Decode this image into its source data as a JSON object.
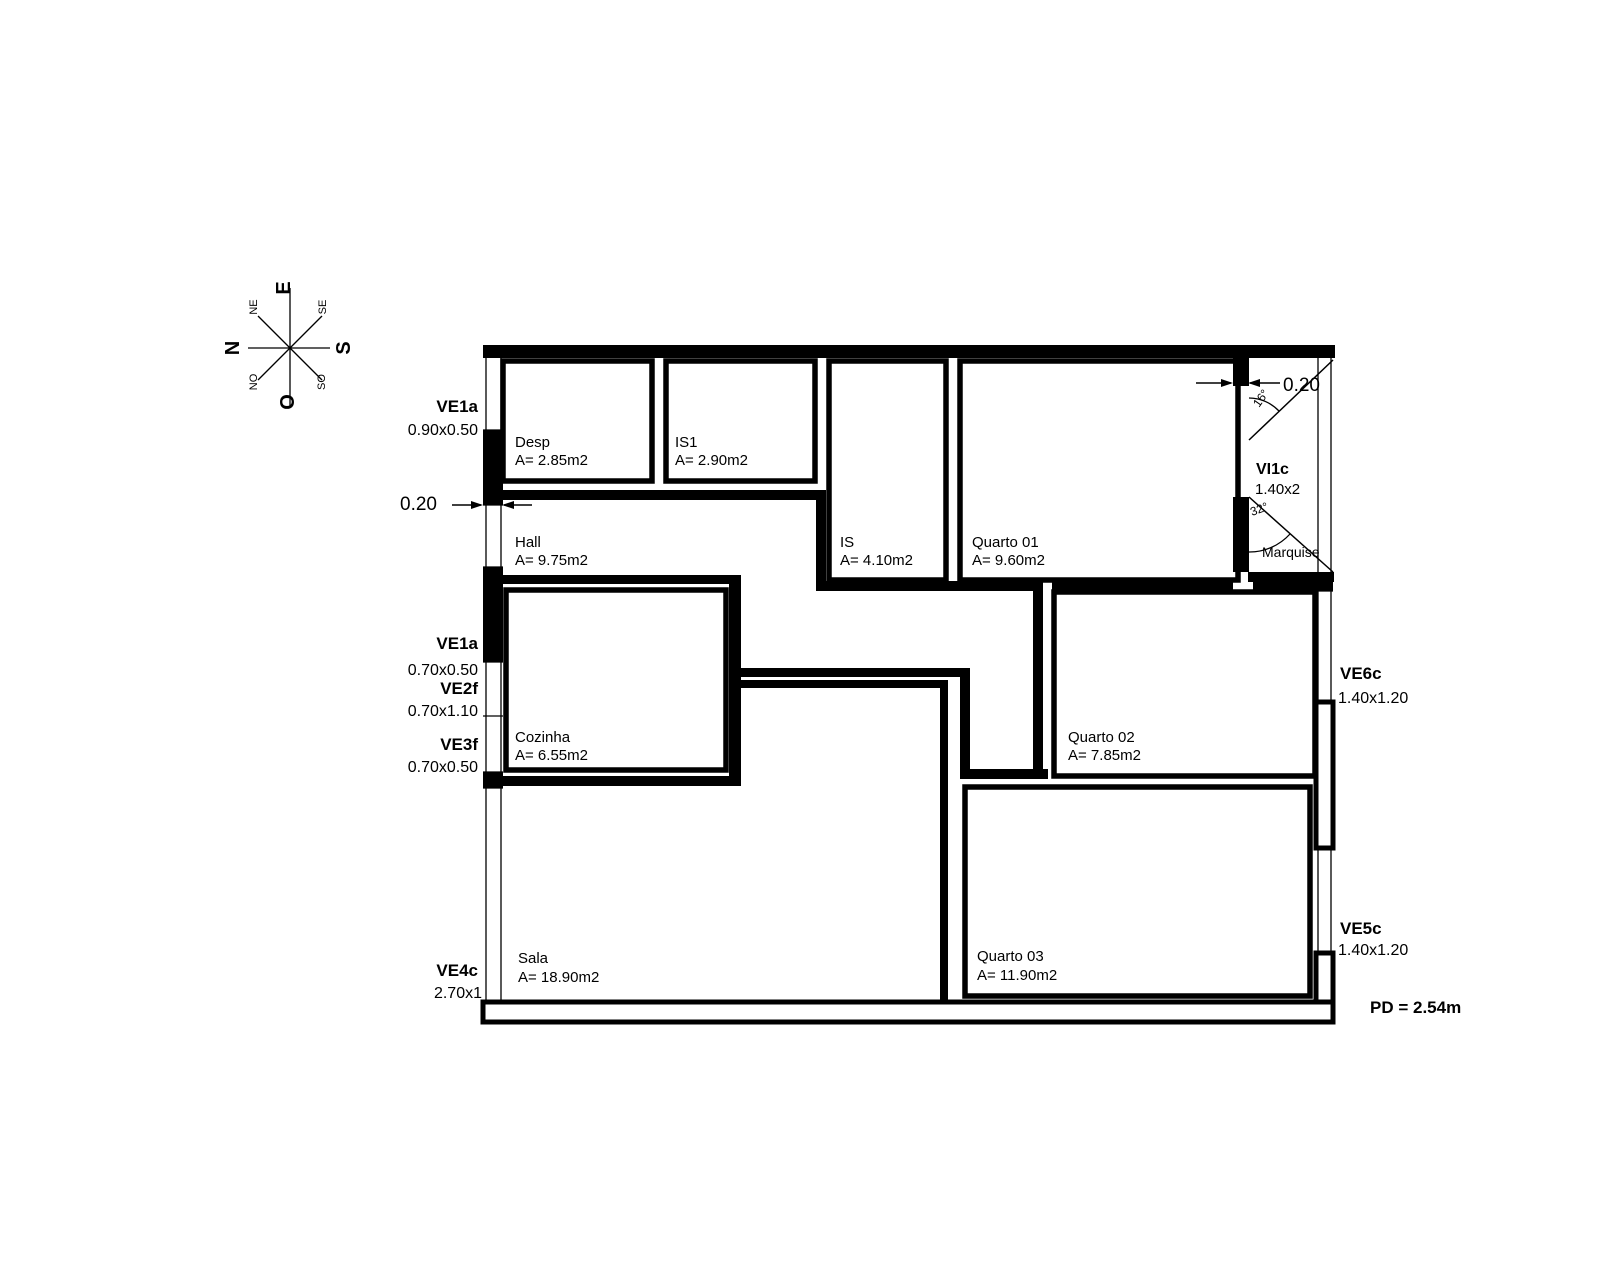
{
  "compass": {
    "top": "E",
    "left": "N",
    "right": "S",
    "bottom": "O",
    "top_left": "NE",
    "top_right": "SE",
    "bottom_left": "NO",
    "bottom_right": "SO"
  },
  "rooms": {
    "desp": {
      "name": "Desp",
      "area": "A= 2.85m2"
    },
    "is1": {
      "name": "IS1",
      "area": "A= 2.90m2"
    },
    "hall": {
      "name": "Hall",
      "area": "A= 9.75m2"
    },
    "is": {
      "name": "IS",
      "area": "A= 4.10m2"
    },
    "quarto01": {
      "name": "Quarto 01",
      "area": "A= 9.60m2"
    },
    "cozinha": {
      "name": "Cozinha",
      "area": "A= 6.55m2"
    },
    "quarto02": {
      "name": "Quarto 02",
      "area": "A= 7.85m2"
    },
    "sala": {
      "name": "Sala",
      "area": "A= 18.90m2"
    },
    "quarto03": {
      "name": "Quarto 03",
      "area": "A= 11.90m2"
    },
    "marquise": {
      "name": "Marquise"
    }
  },
  "openings": {
    "ve1a_desp": {
      "code": "VE1a",
      "size": "0.90x0.50"
    },
    "ve1a_hall": {
      "code": "VE1a",
      "size": "0.70x0.50"
    },
    "ve2f": {
      "code": "VE2f",
      "size": "0.70x1.10"
    },
    "ve3f": {
      "code": "VE3f",
      "size": "0.70x0.50"
    },
    "ve4c": {
      "code": "VE4c",
      "size": "2.70x1"
    },
    "ve5c": {
      "code": "VE5c",
      "size": "1.40x1.20"
    },
    "ve6c": {
      "code": "VE6c",
      "size": "1.40x1.20"
    },
    "vi1c": {
      "code": "VI1c",
      "size": "1.40x2"
    }
  },
  "dimensions": {
    "left_wall": "0.20",
    "right_wall": "0.20"
  },
  "angles": {
    "upper": "16°",
    "lower": "32°"
  },
  "notes": {
    "ceiling_height": "PD = 2.54m"
  },
  "colors": {
    "line": "#000000",
    "dimension": "#cc3344"
  }
}
